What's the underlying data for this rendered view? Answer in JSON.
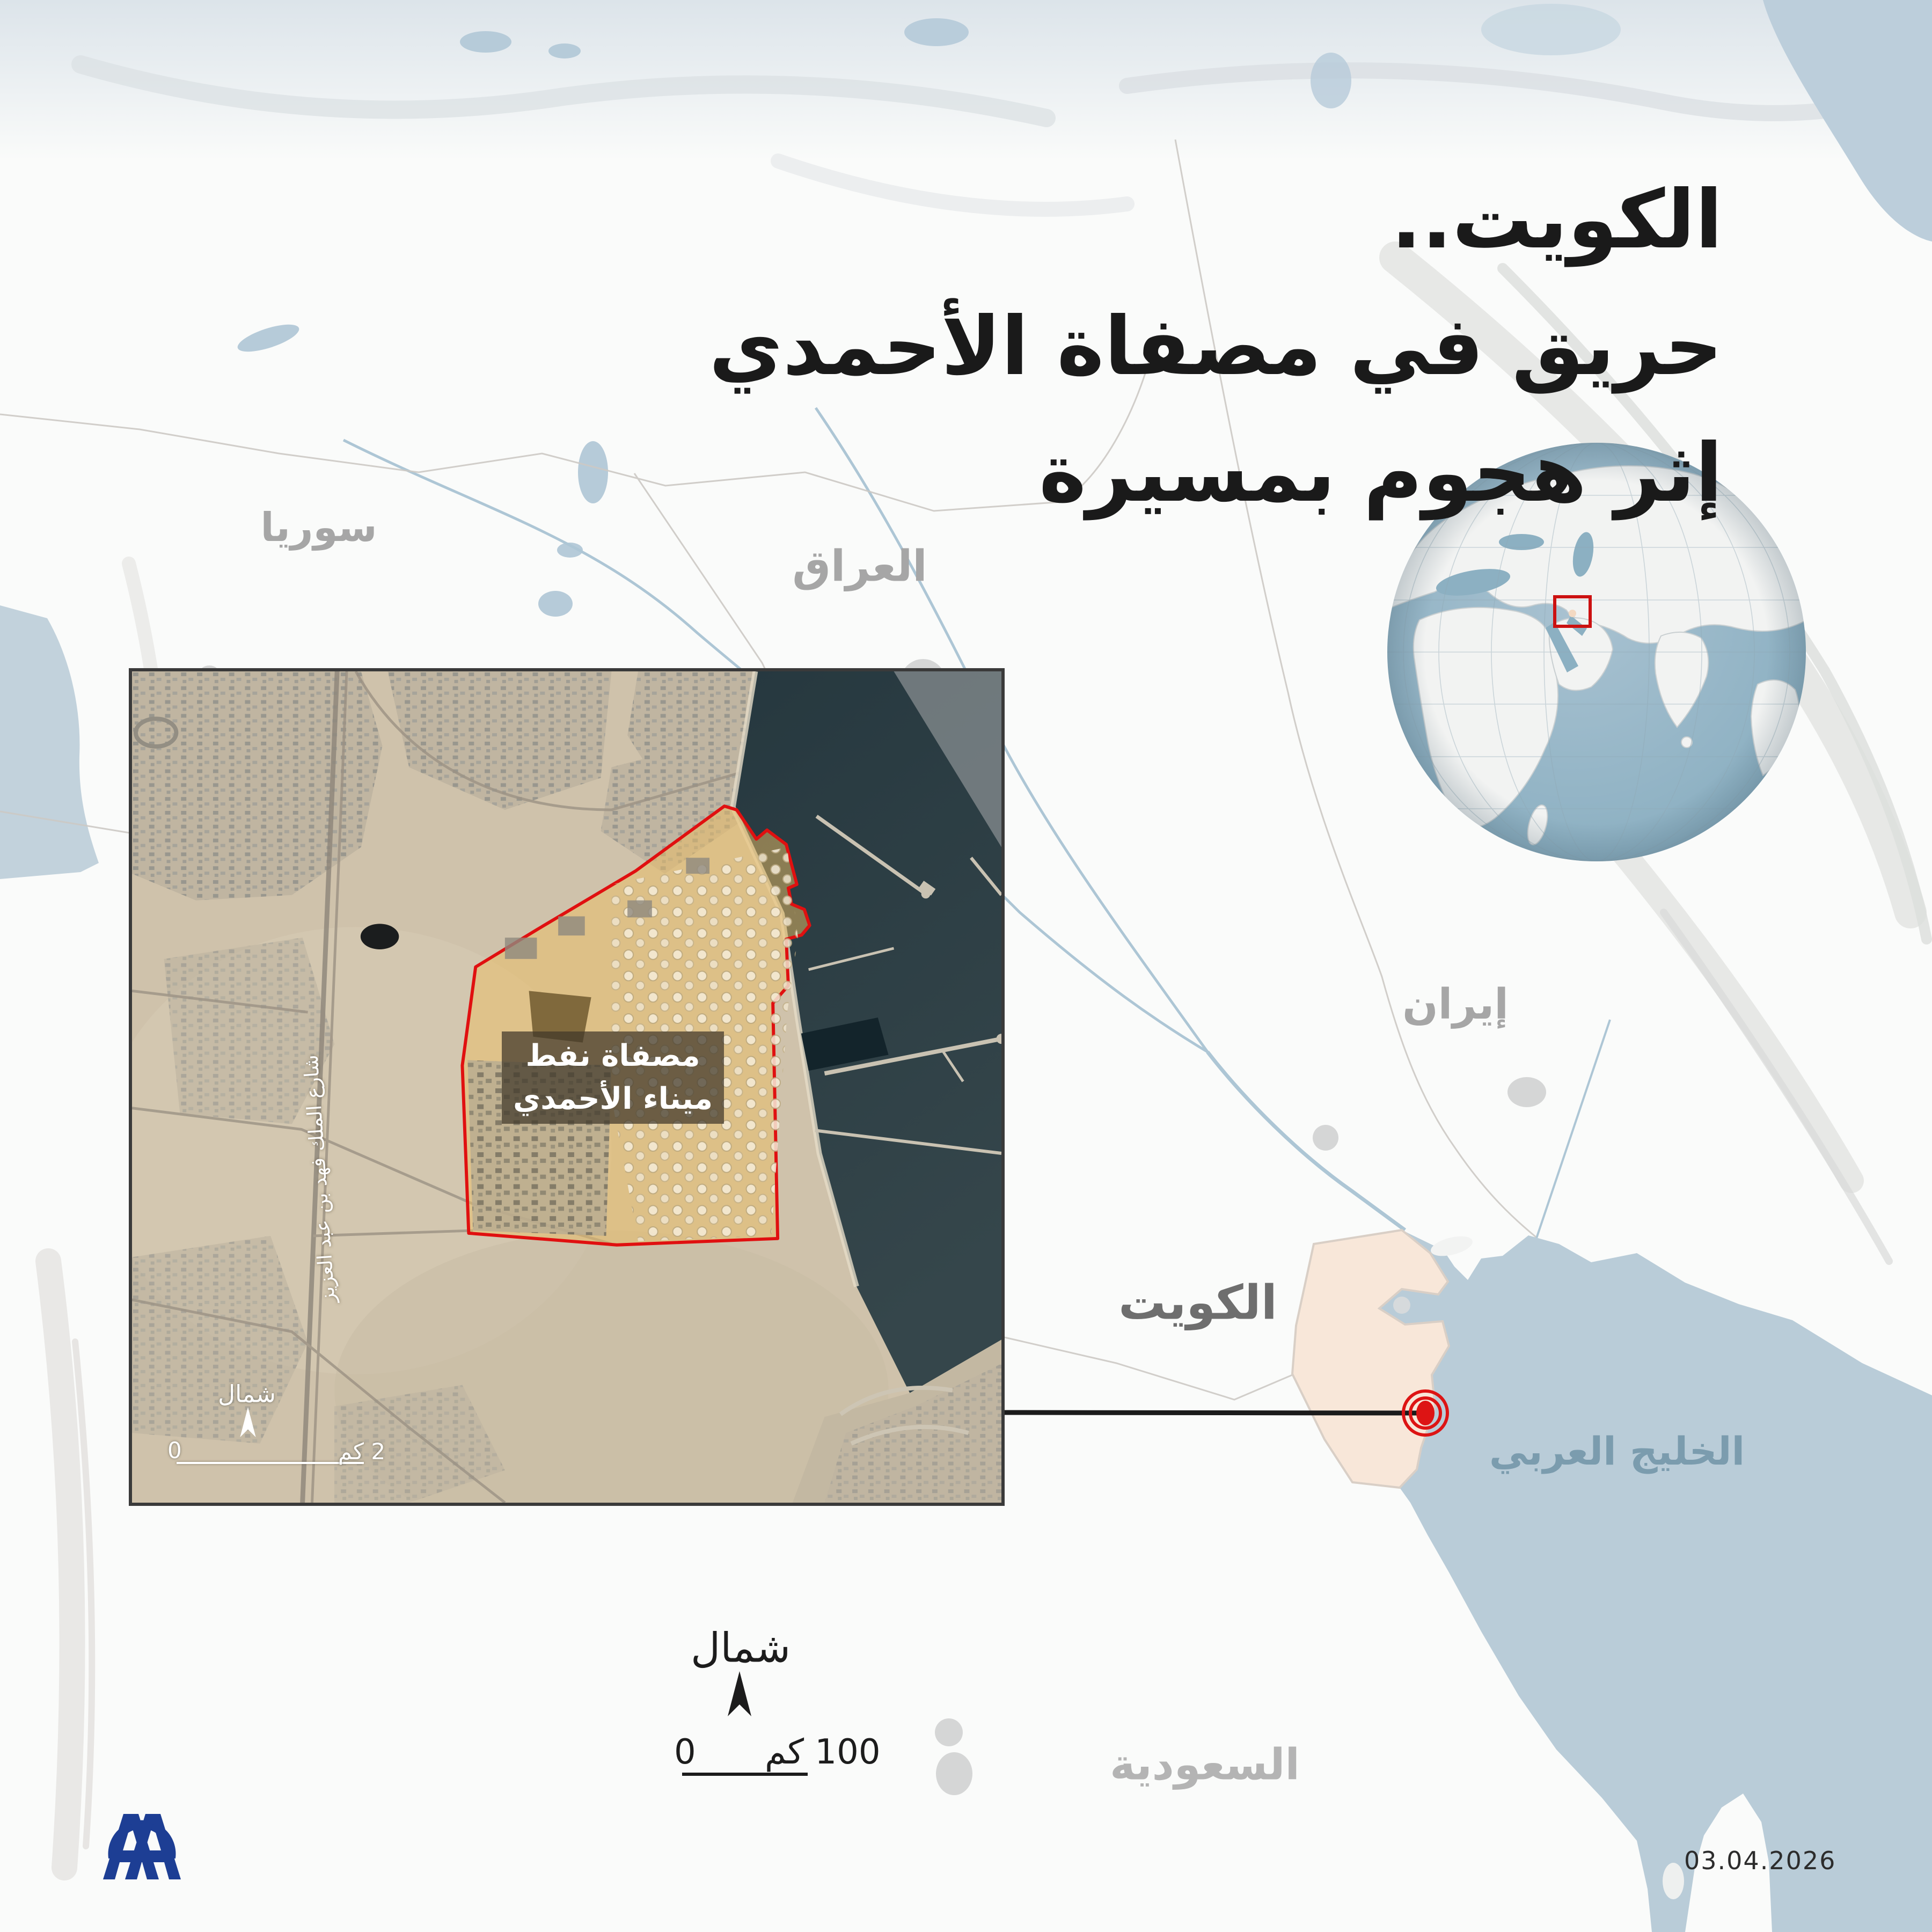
{
  "title": {
    "line1": "الكويت..",
    "line2": "حريق في مصفاة الأحمدي",
    "line3": "إثر هجوم بمسيرة"
  },
  "map_labels": {
    "syria": "سوريا",
    "iraq": "العراق",
    "iran": "إيران",
    "kuwait": "الكويت",
    "saudi_arabia": "السعودية",
    "gulf": "الخليج العربي"
  },
  "inset": {
    "refinery_line1": "مصفاة نفط",
    "refinery_line2": "ميناء الأحمدي",
    "road_label": "شارع الملك فهد بن عبد العزيز",
    "north_label": "شمال",
    "scale_start": "0",
    "scale_end": "2 كم"
  },
  "main_map": {
    "north_label": "شمال",
    "scale_start": "0",
    "scale_end": "100 كم"
  },
  "footer": {
    "date": "03.04.2026"
  },
  "logo": {
    "agency": "AA"
  },
  "colors": {
    "accent_red": "#dd1414",
    "kuwait_fill": "#f8e7d9",
    "sea": "#b9ccd8",
    "inset_sea": "#2a3c42",
    "title_text": "#1a1a1a",
    "country_label": "#a6a6a6",
    "gulf_label": "#7b9cae",
    "logo_blue": "#1d3e94"
  }
}
